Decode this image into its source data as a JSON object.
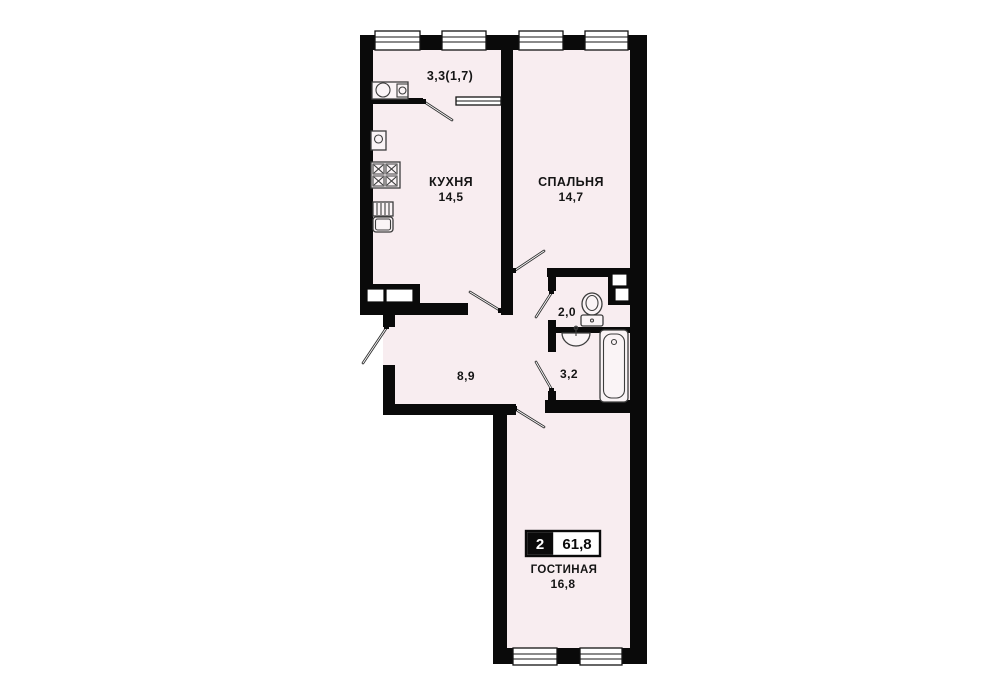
{
  "badge": {
    "rooms_count": "2",
    "total_area": "61,8"
  },
  "rooms": {
    "balcony": {
      "area_label": "3,3(1,7)"
    },
    "kitchen": {
      "name": "КУХНЯ",
      "area": "14,5"
    },
    "bedroom": {
      "name": "СПАЛЬНЯ",
      "area": "14,7"
    },
    "wc": {
      "area": "2,0"
    },
    "bathroom": {
      "area": "3,2"
    },
    "hallway": {
      "area": "8,9"
    },
    "living_room": {
      "name": "ГОСТИНАЯ",
      "area": "16,8"
    }
  },
  "icons": [
    "balcony-sink-icon",
    "washer-icon",
    "stove-icon",
    "kitchen-sink-icon",
    "toilet-icon",
    "washbasin-icon",
    "bathtub-icon"
  ],
  "colors": {
    "wall": "#0a0a0a",
    "floor": "#f8edf0",
    "background": "#ffffff",
    "fixture_stroke": "#3d3d3d",
    "text": "#151515"
  }
}
